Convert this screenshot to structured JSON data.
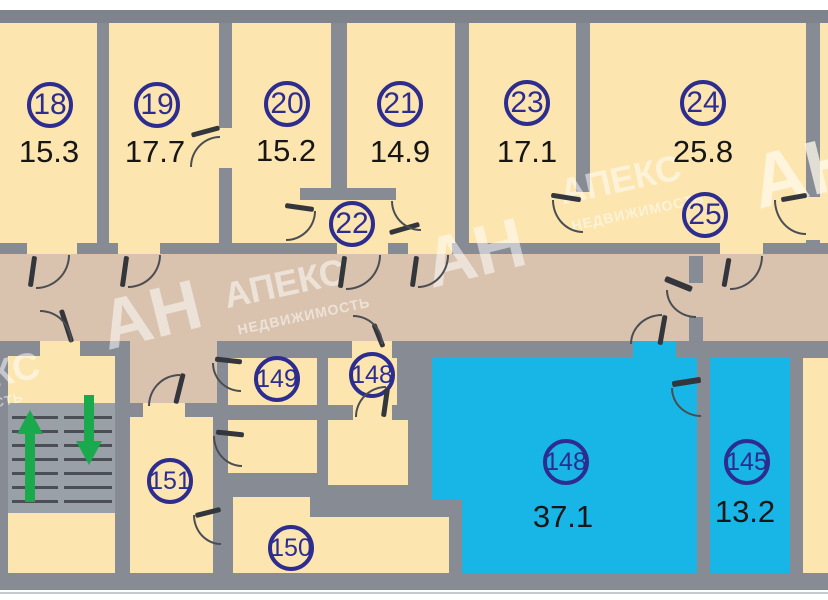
{
  "plan_title": "floor-plan",
  "watermark": {
    "initials": "АН",
    "brand": "АПЕКС",
    "subtitle": "НЕДВИЖИМОСТЬ",
    "partial_top": "КС",
    "partial_bottom": "ОСТЬ"
  },
  "rooms": [
    {
      "number": "18",
      "area": "15.3"
    },
    {
      "number": "19",
      "area": "17.7"
    },
    {
      "number": "20",
      "area": "15.2"
    },
    {
      "number": "21",
      "area": "14.9"
    },
    {
      "number": "22",
      "area": ""
    },
    {
      "number": "23",
      "area": "17.1"
    },
    {
      "number": "24",
      "area": "25.8"
    },
    {
      "number": "25",
      "area": ""
    },
    {
      "number": "149",
      "area": ""
    },
    {
      "number": "148",
      "area": ""
    },
    {
      "number": "151",
      "area": ""
    },
    {
      "number": "150",
      "area": ""
    },
    {
      "number": "148",
      "area": "37.1"
    },
    {
      "number": "145",
      "area": "13.2"
    }
  ],
  "icons": {
    "stairs_up": "up-arrow",
    "stairs_down": "down-arrow"
  },
  "colors": {
    "room_fill": "#fce5ae",
    "corridor_fill": "#d9c3ae",
    "highlight_fill": "#17b6e6",
    "wall": "#878b94",
    "stair_fill": "#9aa0a8",
    "label": "#2d2d90",
    "area_text": "#161616",
    "arrow": "#1ba94e"
  }
}
